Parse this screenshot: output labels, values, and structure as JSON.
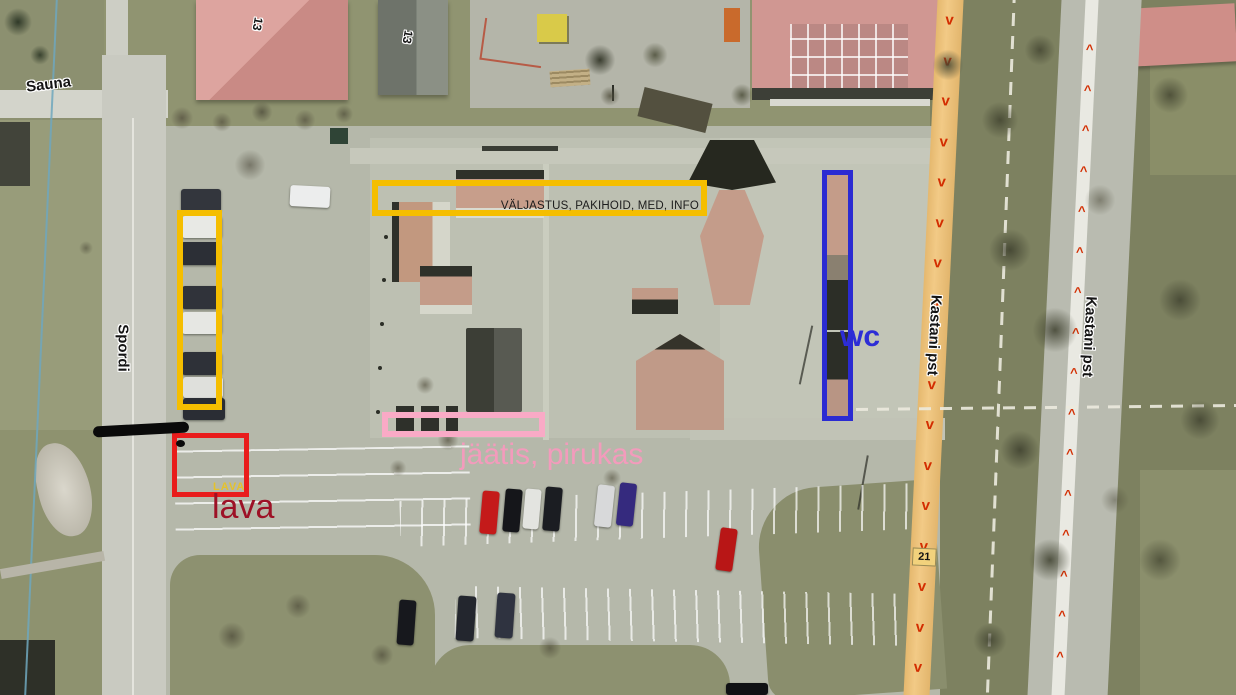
{
  "map": {
    "street_labels": {
      "sauna": "Sauna",
      "spordi": "Spordi",
      "kastani_path": "Kastani pst",
      "kastani_road": "Kastani pst"
    },
    "building_numbers": {
      "left": "13",
      "right": "13"
    },
    "route_marker": "21",
    "path_arrows_down": "v\nv\nv\nv\nv\nv\nv\nv\nv\nv\nv\nv\nv\nv\nv\nv\nv",
    "road_arrows_up": "^\n^\n^\n^\n^\n^\n^\n^\n^\n^\n^\n^\n^\n^\n^\n^"
  },
  "annotations": {
    "issue_area": {
      "label": "VÄLJASTUS, PAKIHOID, MED, INFO",
      "outline_color": "#F5BE00"
    },
    "parking_area": {
      "outline_color": "#F5BE00"
    },
    "wc_area": {
      "label": "wc",
      "outline_color": "#2B2BD2",
      "text_color": "#2D2DD6"
    },
    "food_area": {
      "label": "jäätis, pirukas",
      "outline_color": "#F9AAC6",
      "text_color": "#F39BBC"
    },
    "stage_area": {
      "label": "lava",
      "inner_label": "LAVA",
      "outline_color": "#E91C1C",
      "text_color": "#9D1126",
      "inner_text_color": "#E5C22B"
    }
  }
}
